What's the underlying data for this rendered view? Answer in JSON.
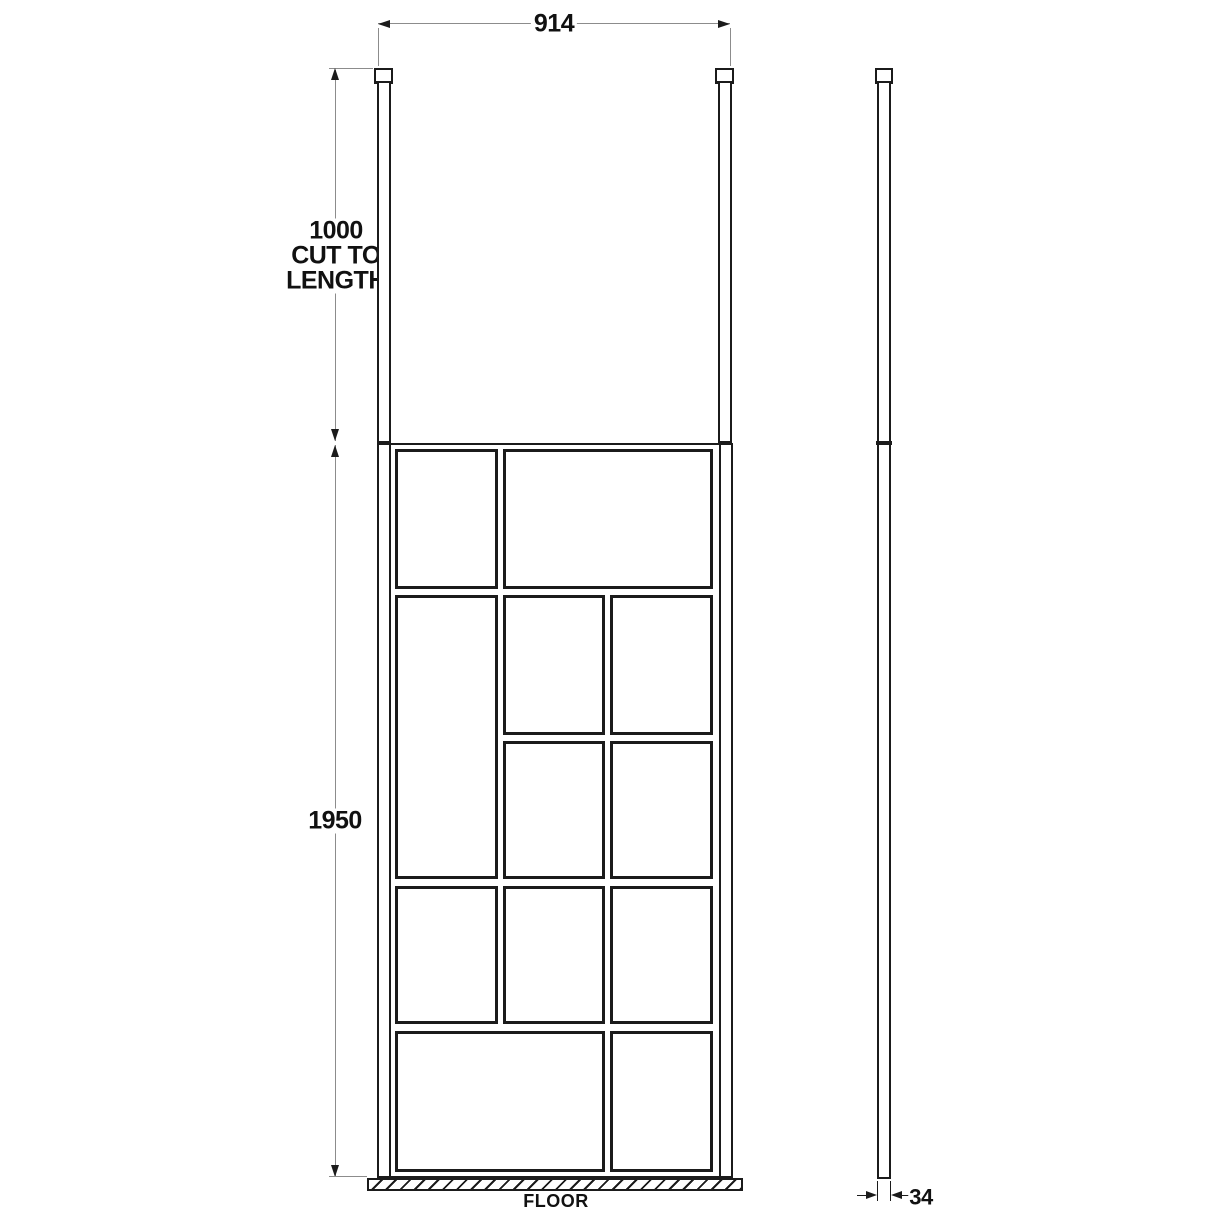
{
  "drawing": {
    "dimensions": {
      "width_label": "914",
      "post_label_lines": [
        "1000",
        "CUT TO",
        "LENGTH"
      ],
      "height_label": "1950",
      "thickness_label": "34"
    },
    "floor_label": "FLOOR",
    "colors": {
      "background": "#ffffff",
      "line": "#1b1b1b",
      "dimension_line": "#8c8c8c",
      "text": "#111111"
    },
    "panel_grid": {
      "rows": 5,
      "columns": 3,
      "panes": [
        {
          "row": 0,
          "col": 0,
          "rowspan": 1,
          "colspan": 1
        },
        {
          "row": 0,
          "col": 1,
          "rowspan": 1,
          "colspan": 2
        },
        {
          "row": 1,
          "col": 0,
          "rowspan": 2,
          "colspan": 1
        },
        {
          "row": 1,
          "col": 1,
          "rowspan": 1,
          "colspan": 1
        },
        {
          "row": 1,
          "col": 2,
          "rowspan": 1,
          "colspan": 1
        },
        {
          "row": 2,
          "col": 1,
          "rowspan": 1,
          "colspan": 1
        },
        {
          "row": 2,
          "col": 2,
          "rowspan": 1,
          "colspan": 1
        },
        {
          "row": 3,
          "col": 0,
          "rowspan": 1,
          "colspan": 1
        },
        {
          "row": 3,
          "col": 1,
          "rowspan": 1,
          "colspan": 1
        },
        {
          "row": 3,
          "col": 2,
          "rowspan": 1,
          "colspan": 1
        },
        {
          "row": 4,
          "col": 0,
          "rowspan": 1,
          "colspan": 2
        },
        {
          "row": 4,
          "col": 2,
          "rowspan": 1,
          "colspan": 1
        }
      ]
    }
  }
}
